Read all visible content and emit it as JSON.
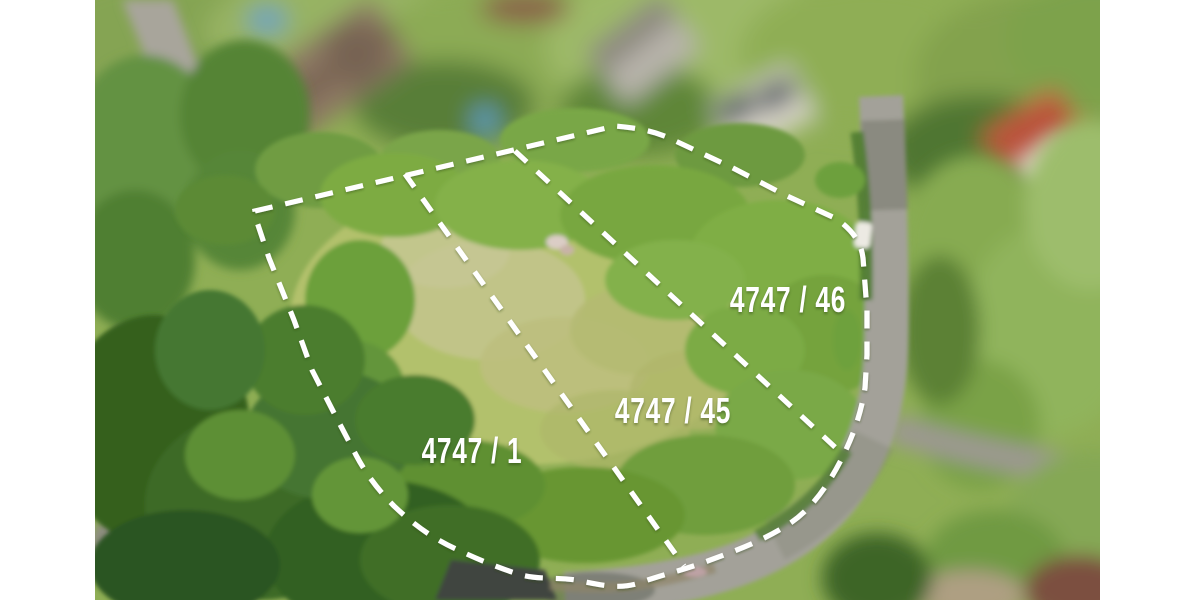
{
  "photo": {
    "alt": "Aerial drone photo of grassy building plots outlined with dashed white boundary lines, surrounded by trees, houses and a curving street",
    "boundary_color": "#ffffff",
    "label_color": "#ffffff"
  },
  "parcels": [
    {
      "label": "4747 / 46"
    },
    {
      "label": "4747 / 45"
    },
    {
      "label": "4747 / 1"
    }
  ],
  "palette": {
    "page_background": "#ffffff",
    "meadow": "#b2c16c",
    "shrubs": "#7dab43",
    "dark_trees": "#35611f",
    "road": "#a3a199"
  }
}
